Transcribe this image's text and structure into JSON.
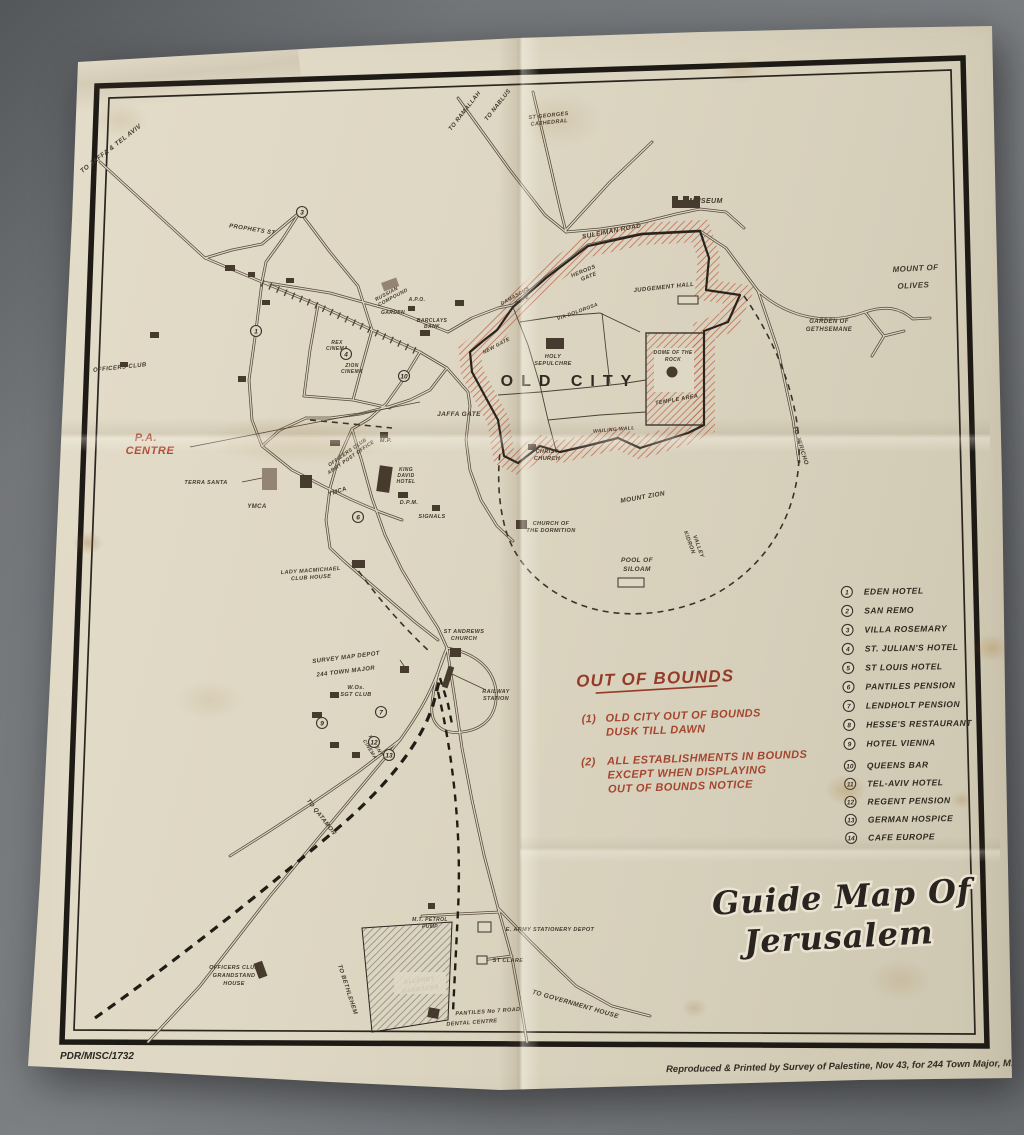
{
  "colors": {
    "backdrop": "#75787b",
    "paper": "#ddd5c2",
    "ink": "#3b332a",
    "red": "#a8432c",
    "hatch_red": "#c2604a"
  },
  "title": {
    "line1": "Guide Map Of",
    "line2": "Jerusalem"
  },
  "footer": {
    "catalog": "PDR/MISC/1732",
    "imprint": "Reproduced & Printed by Survey of Palestine, Nov 43, for 244 Town Major, M.E.F."
  },
  "out_of_bounds": {
    "heading": "OUT OF BOUNDS",
    "items": [
      {
        "num": "(1)",
        "lines": [
          "OLD CITY OUT OF BOUNDS",
          "DUSK TILL DAWN"
        ]
      },
      {
        "num": "(2)",
        "lines": [
          "ALL ESTABLISHMENTS IN BOUNDS",
          "EXCEPT WHEN DISPLAYING",
          "OUT OF BOUNDS NOTICE"
        ]
      }
    ]
  },
  "legend": [
    {
      "num": "1",
      "label": "EDEN HOTEL"
    },
    {
      "num": "2",
      "label": "SAN REMO"
    },
    {
      "num": "3",
      "label": "VILLA ROSEMARY"
    },
    {
      "num": "4",
      "label": "ST. JULIAN'S HOTEL"
    },
    {
      "num": "5",
      "label": "ST LOUIS HOTEL"
    },
    {
      "num": "6",
      "label": "PANTILES PENSION"
    },
    {
      "num": "7",
      "label": "LENDHOLT PENSION"
    },
    {
      "num": "8",
      "label": "HESSE'S RESTAURANT"
    },
    {
      "num": "9",
      "label": "HOTEL VIENNA"
    },
    {
      "num": "10",
      "label": "QUEENS BAR"
    },
    {
      "num": "11",
      "label": "TEL-AVIV HOTEL"
    },
    {
      "num": "12",
      "label": "REGENT PENSION"
    },
    {
      "num": "13",
      "label": "GERMAN HOSPICE"
    },
    {
      "num": "14",
      "label": "CAFE EUROPE"
    }
  ],
  "map_markers": {
    "m1": "1",
    "m3": "3",
    "m4": "4",
    "m6": "6",
    "m7": "7",
    "m9": "9",
    "m10": "10",
    "m12": "12",
    "m13": "13"
  },
  "labels": {
    "to_jaffa": "TO JAFFA & TEL AVIV",
    "to_ramallah": "TO RAMALLAH",
    "to_nablus": "TO NABLUS",
    "st_georges_1": "ST GEORGES",
    "st_georges_2": "CATHEDRAL",
    "prophets_st": "PROPHETS ST",
    "museum": "MUSEUM",
    "suleiman_road": "SULEIMAN ROAD",
    "mount_of_olives_1": "MOUNT OF",
    "mount_of_olives_2": "OLIVES",
    "gethsemane_1": "GARDEN OF",
    "gethsemane_2": "GETHSEMANE",
    "to_jericho": "TO JERICHO",
    "herods_gate_1": "HERODS",
    "herods_gate_2": "GATE",
    "judgement_hall": "JUDGEMENT HALL",
    "via_dolorosa": "VIA DOLOROSA",
    "damascus_gate_1": "DAMASCUS",
    "damascus_gate_2": "GATE",
    "new_gate": "NEW GATE",
    "old_city": "OLD CITY",
    "holy_sepulchre_1": "HOLY",
    "holy_sepulchre_2": "SEPULCHRE",
    "dome_1": "DOME OF THE",
    "dome_2": "ROCK",
    "temple_area": "TEMPLE AREA",
    "wailing_wall": "WAILING WALL",
    "jaffa_gate": "JAFFA GATE",
    "christ_church_1": "CHRIST",
    "christ_church_2": "CHURCH",
    "mount_zion": "MOUNT ZION",
    "dormition_1": "CHURCH OF",
    "dormition_2": "THE DORMITION",
    "pool_1": "POOL OF",
    "pool_2": "SILOAM",
    "kidron_1": "KIDRON",
    "kidron_2": "VALLEY",
    "pa_centre_1": "P.A.",
    "pa_centre_2": "CENTRE",
    "terra_santa": "TERRA SANTA",
    "ymca": "YMCA",
    "ymca2": "YMCA",
    "king_david_1": "KING",
    "king_david_2": "DAVID",
    "king_david_3": "HOTEL",
    "dpm": "D.P.M.",
    "signals": "SIGNALS",
    "mp": "M.P.",
    "oc_apo_1": "OFFICERS CLUB",
    "oc_apo_2": "ARMY POST OFFICE",
    "officers_club": "OFFICERS CLUB",
    "russian_1": "RUSSIAN",
    "russian_2": "COMPOUND",
    "apo": "A.P.O.",
    "garden": "GARDEN",
    "barclays_1": "BARCLAYS",
    "barclays_2": "BANK",
    "rex_1": "REX",
    "rex_2": "CINEMA",
    "zion_1": "ZION",
    "zion_2": "CINEMA",
    "lady_1": "LADY MACMICHAEL",
    "lady_2": "CLUB HOUSE",
    "st_andrews_1": "ST ANDREWS",
    "st_andrews_2": "CHURCH",
    "survey_1": "SURVEY MAP DEPOT",
    "survey_2": "244 TOWN MAJOR",
    "wos_1": "W.Os.",
    "wos_2": "SGT CLUB",
    "railway_1": "RAILWAY",
    "railway_2": "STATION",
    "regent_1": "REGENT",
    "regent_2": "CINEMA",
    "to_qatamon": "TO QATAMON",
    "to_bethlehem": "TO BETHLEHEM",
    "ocg_1": "OFFICERS CLUB",
    "ocg_2": "GRANDSTAND",
    "ocg_3": "HOUSE",
    "petrol_1": "M.T. PETROL",
    "petrol_2": "PUMP",
    "stationery": "E. ARMY STATIONERY DEPOT",
    "st_clare": "ST CLARE",
    "allenby_1": "ALLENBY",
    "allenby_2": "BARRACKS",
    "pantiles_1": "PANTILES No 7 ROAD",
    "pantiles_2": "DENTAL CENTRE",
    "to_govt": "TO GOVERNMENT HOUSE"
  }
}
